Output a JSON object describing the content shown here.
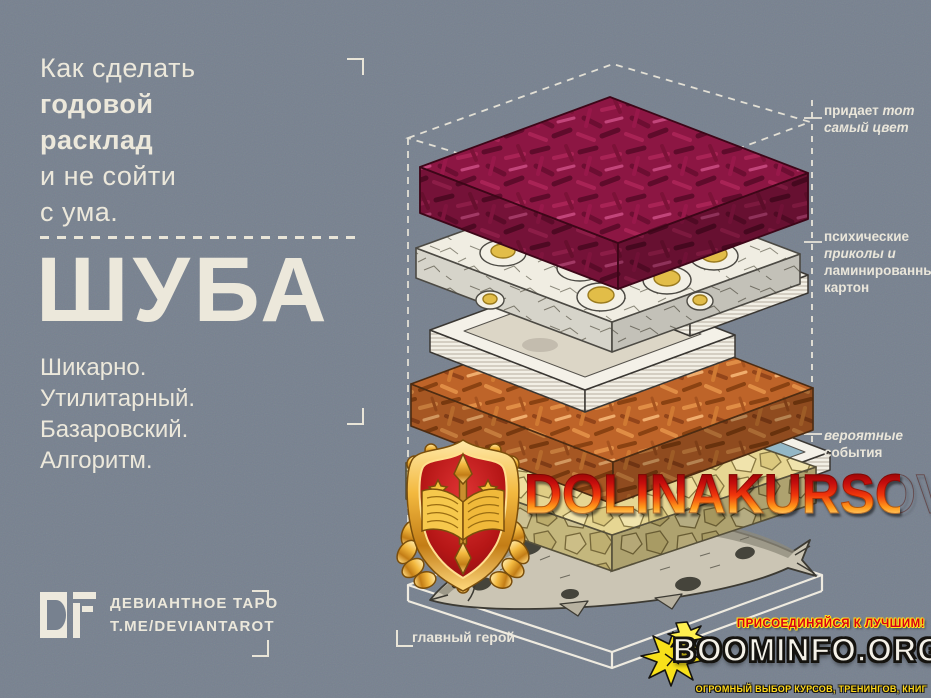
{
  "colors": {
    "background": "#77818F",
    "text_cream": "#ECE8DB",
    "beet": "#8C1643",
    "carrot": "#BE6429",
    "potato": "#E6D693",
    "egg_yolk": "#E2BD48",
    "watermark_red": "#C40D0D",
    "watermark_gold": "#FFC83C",
    "boominfo_yellow": "#FFD91A",
    "boominfo_red": "#D90016"
  },
  "poster": {
    "intro_lines": [
      "Как сделать",
      "годовой",
      "расклад",
      "и не сойти",
      "с ума."
    ],
    "title": "ШУБА",
    "tagline_lines": [
      "Шикарно.",
      "Утилитарный.",
      "Базаровский.",
      "Алгоритм."
    ],
    "labels": {
      "beet_bold": "придает",
      "beet_italic": "тот самый цвет",
      "cards_bold1": "психические",
      "cards_italic": "приколы и",
      "cards_bold2": "ламинированный картон",
      "events_italic": "вероятные",
      "events_bold": "события",
      "hero": "главный герой"
    },
    "footer": {
      "logo_glyph": "DF",
      "brand": "ДЕВИАНТНОЕ ТАРО",
      "handle": "T.ME/DEVIANTAROT"
    }
  },
  "diagram": {
    "card_caption": "THE LOVERS"
  },
  "watermark": {
    "text": "DOLINAKURSOV"
  },
  "boominfo": {
    "tagline_top": "ПРИСОЕДИНЯЙСЯ К ЛУЧШИМ!",
    "title": "BOOMINFO.ORG",
    "tagline_bottom": "ОГРОМНЫЙ ВЫБОР КУРСОВ, ТРЕНИНГОВ, КНИГ"
  }
}
